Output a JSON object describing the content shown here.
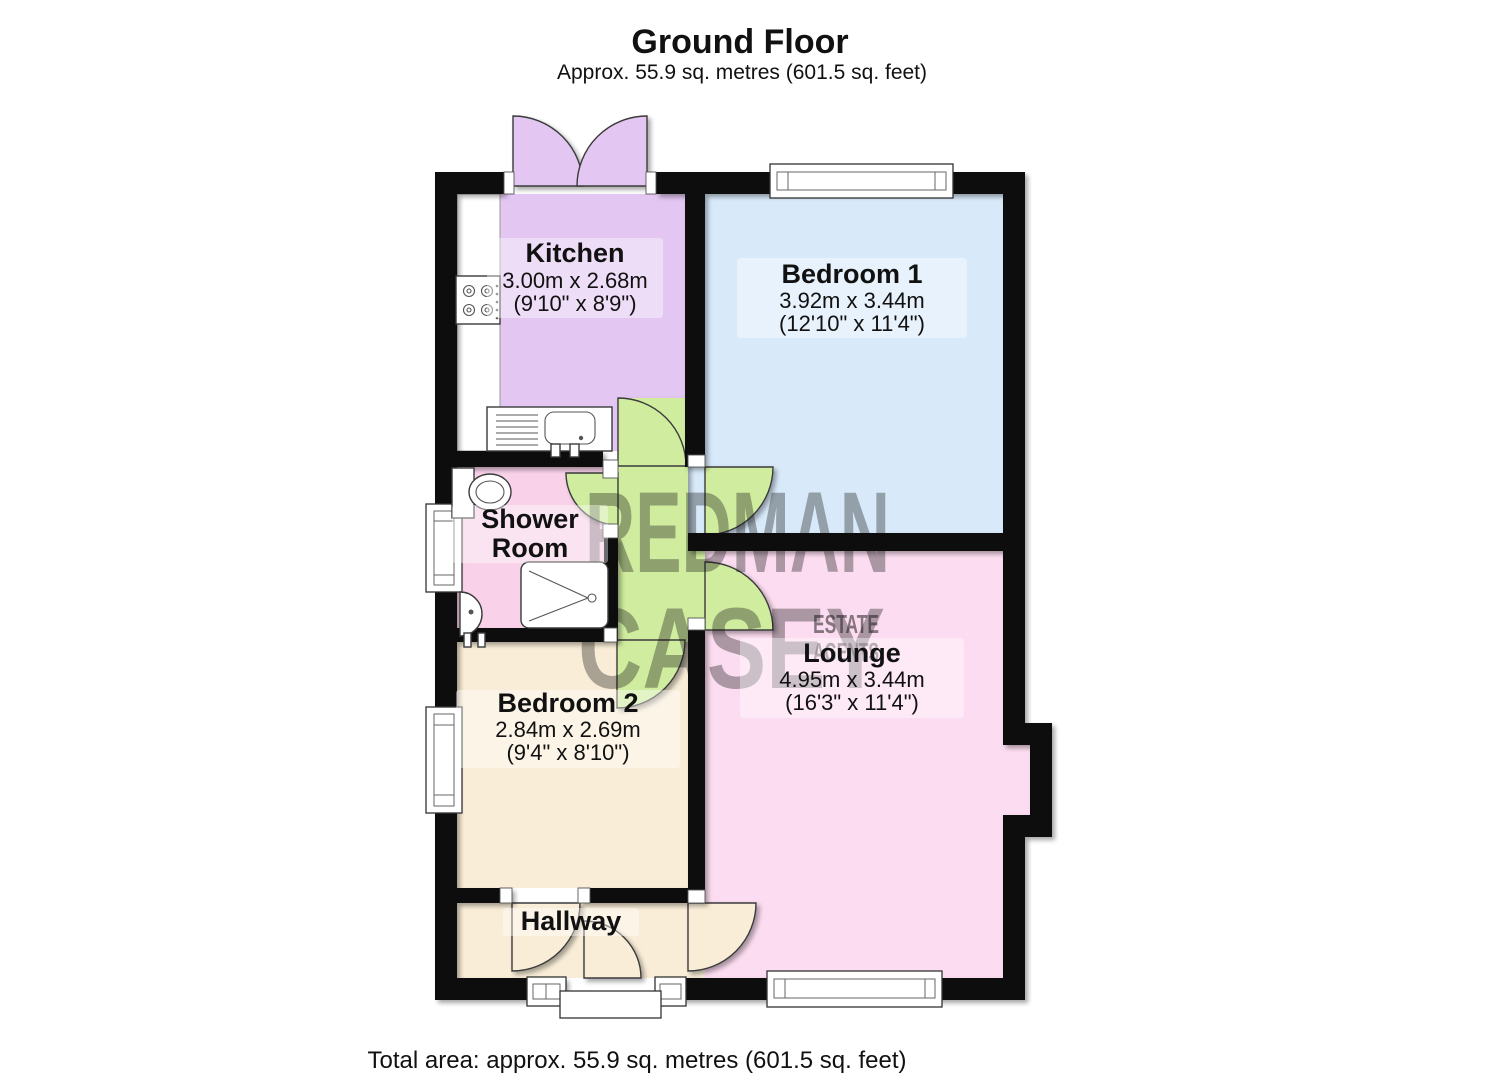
{
  "title": {
    "heading": "Ground Floor",
    "subtitle": "Approx. 55.9 sq. metres (601.5 sq. feet)"
  },
  "footer": {
    "total": "Total area: approx. 55.9 sq. metres (601.5 sq. feet)"
  },
  "watermark": {
    "word1": "REDMAN",
    "word2": "CASEY",
    "word3": "ESTATE",
    "word4": "AGENTS"
  },
  "rooms": {
    "kitchen": {
      "name": "Kitchen",
      "metric": "3.00m x 2.68m",
      "imperial": "(9'10\" x 8'9\")",
      "color": "#e3c6f2"
    },
    "bedroom1": {
      "name": "Bedroom 1",
      "metric": "3.92m x 3.44m",
      "imperial": "(12'10\" x 11'4\")",
      "color": "#d8eafa"
    },
    "shower_room": {
      "name_line1": "Shower",
      "name_line2": "Room",
      "color": "#f9d2e9"
    },
    "bedroom2": {
      "name": "Bedroom 2",
      "metric": "2.84m x 2.69m",
      "imperial": "(9'4\" x 8'10\")",
      "color": "#f9edd7"
    },
    "lounge": {
      "name": "Lounge",
      "metric": "4.95m x 3.44m",
      "imperial": "(16'3\" x 11'4\")",
      "color": "#fcdcf0"
    },
    "hallway": {
      "name": "Hallway",
      "color": "#f9edd7"
    },
    "inner_hall": {
      "color": "#cfec9f"
    }
  },
  "colors": {
    "wall": "#0c0c0c",
    "watermark": "#b5638f",
    "counter": "#ffffff"
  }
}
